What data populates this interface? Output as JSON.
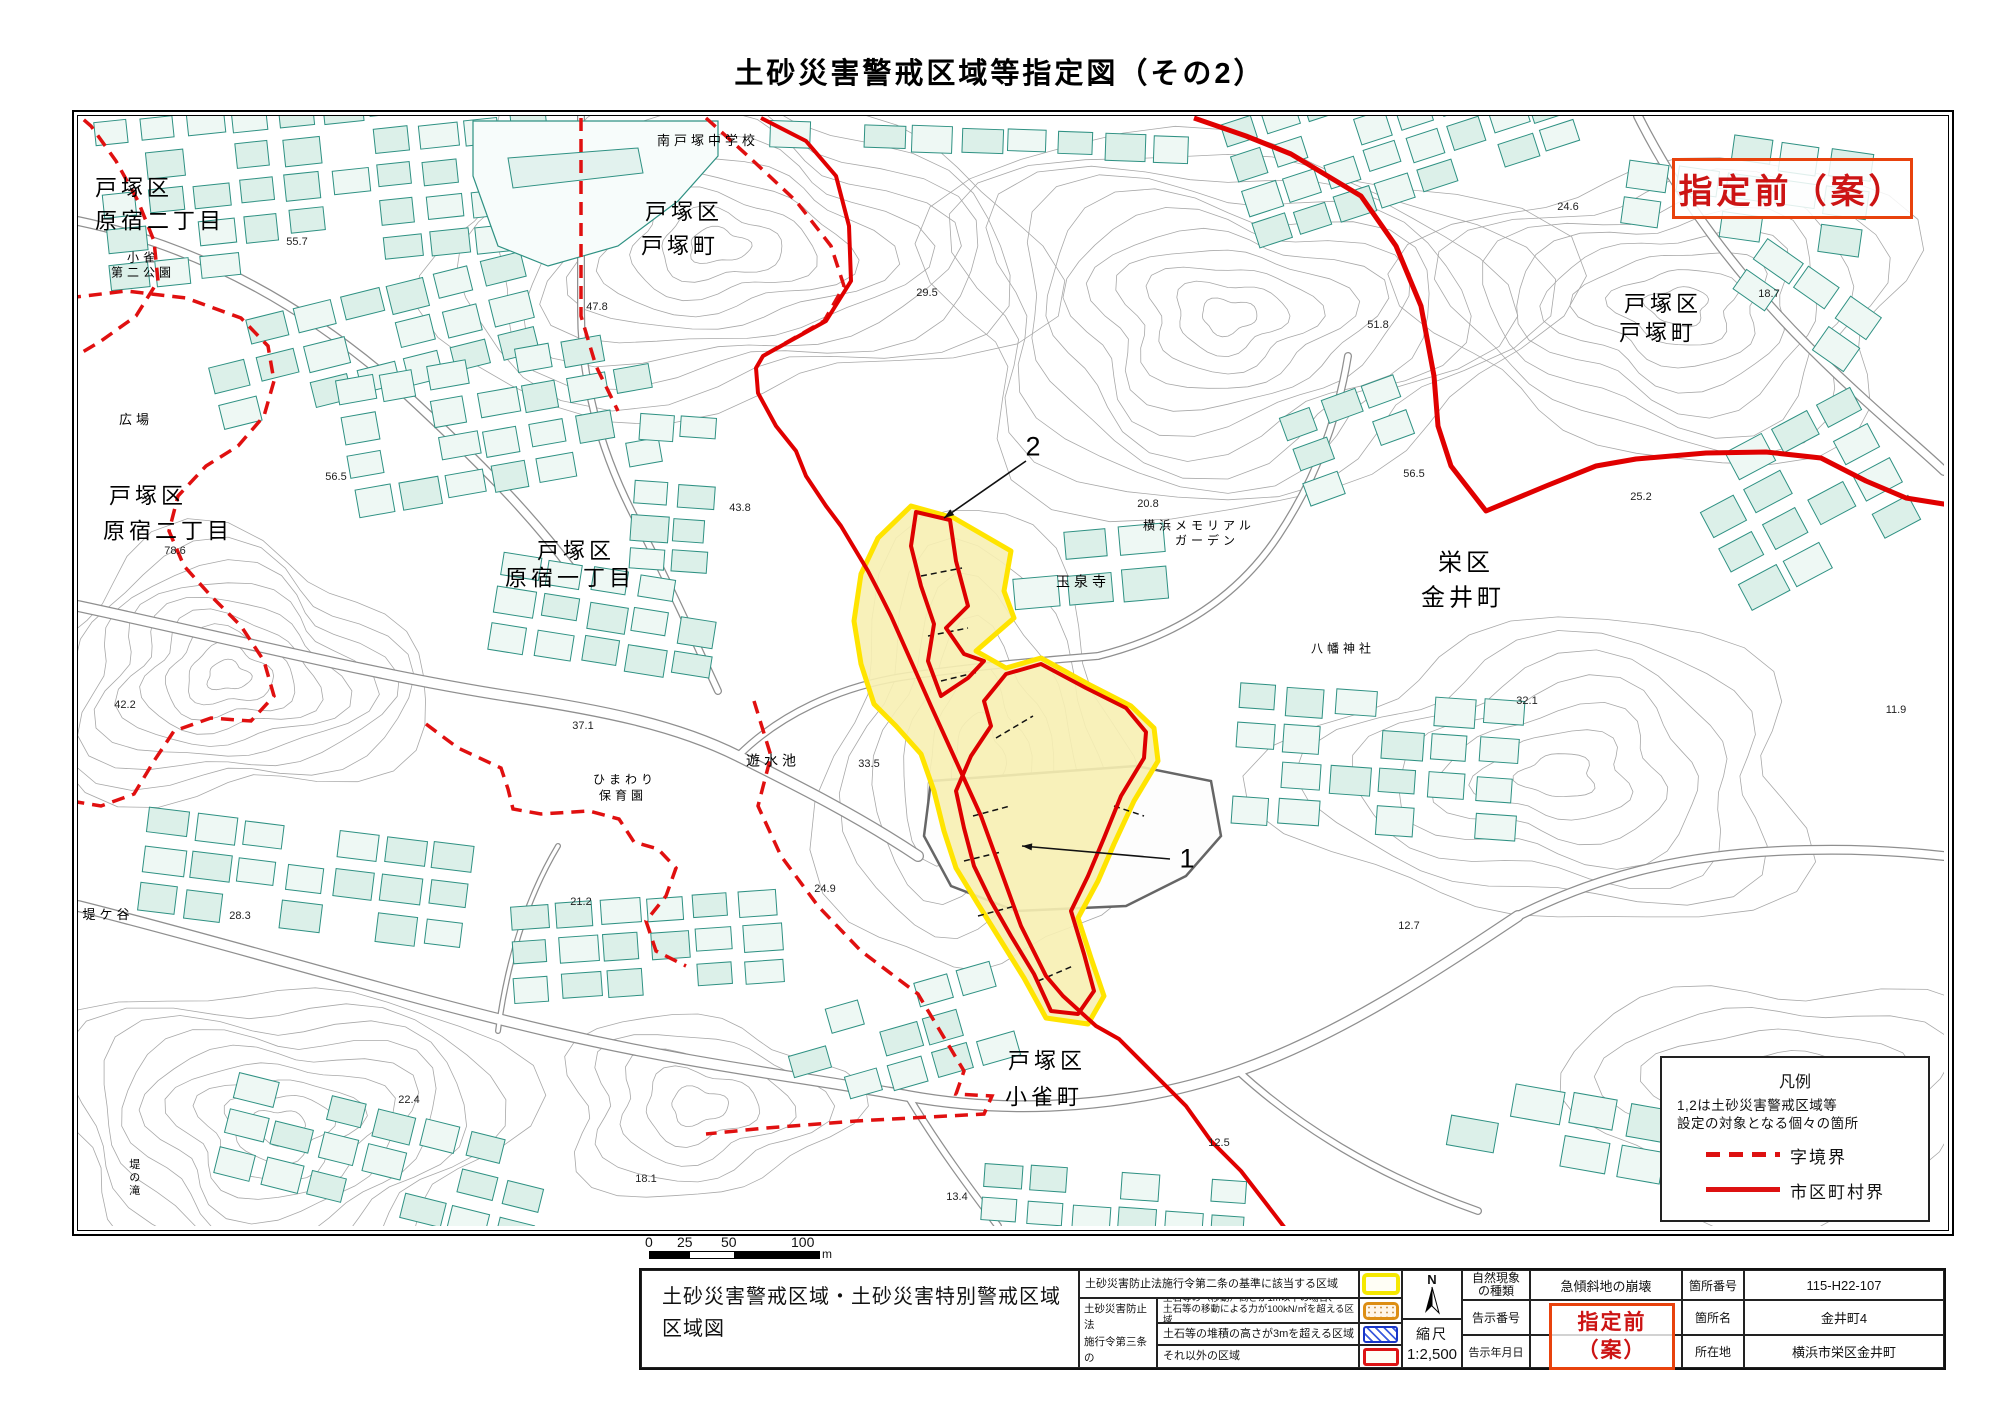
{
  "title": "土砂災害警戒区域等指定図（その2）",
  "stamp": {
    "text": "指定前（案）"
  },
  "legend_panel": {
    "title": "凡例",
    "note1": "1,2は土砂災害警戒区域等",
    "note2": "設定の対象となる個々の箇所",
    "items": [
      {
        "style": "dashed",
        "label": "字境界"
      },
      {
        "style": "solid",
        "label": "市区町村界"
      }
    ]
  },
  "scalebar": {
    "t0": "0",
    "t25": "25",
    "t50": "50",
    "t100": "100",
    "unit": "m"
  },
  "info_table": {
    "map_title1": "土砂災害警戒区域・土砂災害特別警戒区域",
    "map_title2": "区域図",
    "row_2jo": "土砂災害防止法施行令第二条の基準に該当する区域",
    "group_3jo": {
      "l1": "土砂災害防止法",
      "l2": "施行令第三条の",
      "l3": "基準に該当する",
      "l4": "区域"
    },
    "row_move_l1": "土石等の（移動）高さが1m以下の場合、",
    "row_move_l2": "土石等の移動による力が100kN/㎡を超える区域",
    "row_pile": "土石等の堆積の高さが3mを超える区域",
    "row_other": "それ以外の区域",
    "compass_n": "N",
    "scale_label": "縮尺",
    "scale_value": "1:2,500",
    "nature_label_l1": "自然現象",
    "nature_label_l2": "の種類",
    "nature_value": "急傾斜地の崩壊",
    "kokuji_no_label": "告示番号",
    "kokuji_date_label": "告示年月日",
    "stamp_l1": "指定前",
    "stamp_l2": "（案）",
    "basho_no_label": "箇所番号",
    "basho_no_value": "115-H22-107",
    "basho_name_label": "箇所名",
    "basho_name_value": "金井町4",
    "location_label": "所在地",
    "location_value": "横浜市栄区金井町"
  },
  "map_labels": [
    {
      "t": "戸塚区",
      "x": 56,
      "y": 72,
      "fs": 22,
      "cls": "place"
    },
    {
      "t": "原宿二丁目",
      "x": 82,
      "y": 105,
      "fs": 22,
      "cls": "place"
    },
    {
      "t": "小雀",
      "x": 65,
      "y": 142,
      "fs": 12,
      "cls": "place"
    },
    {
      "t": "第二公園",
      "x": 65,
      "y": 157,
      "fs": 12,
      "cls": "place"
    },
    {
      "t": "55.7",
      "x": 219,
      "y": 127,
      "fs": 11,
      "cls": "elev"
    },
    {
      "t": "南戸塚中学校",
      "x": 630,
      "y": 25,
      "fs": 13,
      "cls": "place"
    },
    {
      "t": "戸塚区",
      "x": 606,
      "y": 96,
      "fs": 22,
      "cls": "place"
    },
    {
      "t": "戸塚町",
      "x": 602,
      "y": 130,
      "fs": 22,
      "cls": "place"
    },
    {
      "t": "47.8",
      "x": 519,
      "y": 192,
      "fs": 11,
      "cls": "elev"
    },
    {
      "t": "29.5",
      "x": 849,
      "y": 178,
      "fs": 11,
      "cls": "elev"
    },
    {
      "t": "24.6",
      "x": 1490,
      "y": 92,
      "fs": 11,
      "cls": "elev"
    },
    {
      "t": "戸塚区",
      "x": 1585,
      "y": 188,
      "fs": 22,
      "cls": "place"
    },
    {
      "t": "戸塚町",
      "x": 1580,
      "y": 217,
      "fs": 22,
      "cls": "place"
    },
    {
      "t": "18.7",
      "x": 1691,
      "y": 179,
      "fs": 11,
      "cls": "elev"
    },
    {
      "t": "51.8",
      "x": 1300,
      "y": 210,
      "fs": 11,
      "cls": "elev"
    },
    {
      "t": "25.2",
      "x": 1563,
      "y": 382,
      "fs": 11,
      "cls": "elev"
    },
    {
      "t": "広場",
      "x": 58,
      "y": 304,
      "fs": 13,
      "cls": "place"
    },
    {
      "t": "戸塚区",
      "x": 70,
      "y": 380,
      "fs": 22,
      "cls": "place"
    },
    {
      "t": "原宿二丁目",
      "x": 90,
      "y": 415,
      "fs": 22,
      "cls": "place"
    },
    {
      "t": "78.6",
      "x": 97,
      "y": 436,
      "fs": 11,
      "cls": "elev"
    },
    {
      "t": "56.5",
      "x": 258,
      "y": 362,
      "fs": 11,
      "cls": "elev"
    },
    {
      "t": "42.2",
      "x": 47,
      "y": 590,
      "fs": 11,
      "cls": "elev"
    },
    {
      "t": "戸塚区",
      "x": 498,
      "y": 435,
      "fs": 22,
      "cls": "place"
    },
    {
      "t": "原宿一丁目",
      "x": 492,
      "y": 462,
      "fs": 22,
      "cls": "place"
    },
    {
      "t": "37.1",
      "x": 505,
      "y": 611,
      "fs": 11,
      "cls": "elev"
    },
    {
      "t": "遊水池",
      "x": 695,
      "y": 645,
      "fs": 14,
      "cls": "place"
    },
    {
      "t": "ひまわり",
      "x": 547,
      "y": 664,
      "fs": 12,
      "cls": "place"
    },
    {
      "t": "保育園",
      "x": 545,
      "y": 680,
      "fs": 12,
      "cls": "place"
    },
    {
      "t": "33.5",
      "x": 791,
      "y": 649,
      "fs": 11,
      "cls": "elev"
    },
    {
      "t": "43.8",
      "x": 662,
      "y": 393,
      "fs": 11,
      "cls": "elev"
    },
    {
      "t": "玉泉寺",
      "x": 1005,
      "y": 466,
      "fs": 14,
      "cls": "place"
    },
    {
      "t": "20.8",
      "x": 1070,
      "y": 389,
      "fs": 11,
      "cls": "elev"
    },
    {
      "t": "横浜メモリアル",
      "x": 1121,
      "y": 410,
      "fs": 12,
      "cls": "place"
    },
    {
      "t": "ガーデン",
      "x": 1129,
      "y": 425,
      "fs": 12,
      "cls": "place"
    },
    {
      "t": "栄区",
      "x": 1388,
      "y": 447,
      "fs": 24,
      "cls": "place"
    },
    {
      "t": "金井町",
      "x": 1385,
      "y": 482,
      "fs": 24,
      "cls": "place"
    },
    {
      "t": "56.5",
      "x": 1336,
      "y": 359,
      "fs": 11,
      "cls": "elev"
    },
    {
      "t": "八幡神社",
      "x": 1265,
      "y": 533,
      "fs": 12,
      "cls": "place"
    },
    {
      "t": "32.1",
      "x": 1449,
      "y": 586,
      "fs": 11,
      "cls": "elev"
    },
    {
      "t": "11.9",
      "x": 1818,
      "y": 595,
      "fs": 11,
      "cls": "elev"
    },
    {
      "t": "12.7",
      "x": 1331,
      "y": 811,
      "fs": 11,
      "cls": "elev"
    },
    {
      "t": "堤ケ谷",
      "x": 30,
      "y": 799,
      "fs": 13,
      "cls": "place"
    },
    {
      "t": "28.3",
      "x": 162,
      "y": 801,
      "fs": 11,
      "cls": "elev"
    },
    {
      "t": "22.4",
      "x": 331,
      "y": 985,
      "fs": 11,
      "cls": "elev"
    },
    {
      "t": "堤の滝",
      "x": 55,
      "y": 1062,
      "fs": 11,
      "cls": "vert"
    },
    {
      "t": "24.9",
      "x": 747,
      "y": 774,
      "fs": 11,
      "cls": "elev"
    },
    {
      "t": "21.2",
      "x": 503,
      "y": 787,
      "fs": 11,
      "cls": "elev"
    },
    {
      "t": "13.4",
      "x": 879,
      "y": 1082,
      "fs": 11,
      "cls": "elev"
    },
    {
      "t": "12.5",
      "x": 1141,
      "y": 1028,
      "fs": 11,
      "cls": "elev"
    },
    {
      "t": "18.1",
      "x": 568,
      "y": 1064,
      "fs": 11,
      "cls": "elev"
    },
    {
      "t": "戸塚区",
      "x": 969,
      "y": 945,
      "fs": 22,
      "cls": "place"
    },
    {
      "t": "小雀町",
      "x": 966,
      "y": 981,
      "fs": 22,
      "cls": "place"
    }
  ],
  "zone_markers": [
    {
      "t": "2",
      "x": 955,
      "y": 331,
      "ax1": 948,
      "ay1": 345,
      "ax2": 866,
      "ay2": 402
    },
    {
      "t": "1",
      "x": 1109,
      "y": 743,
      "ax1": 1092,
      "ay1": 743,
      "ax2": 944,
      "ay2": 730
    }
  ]
}
